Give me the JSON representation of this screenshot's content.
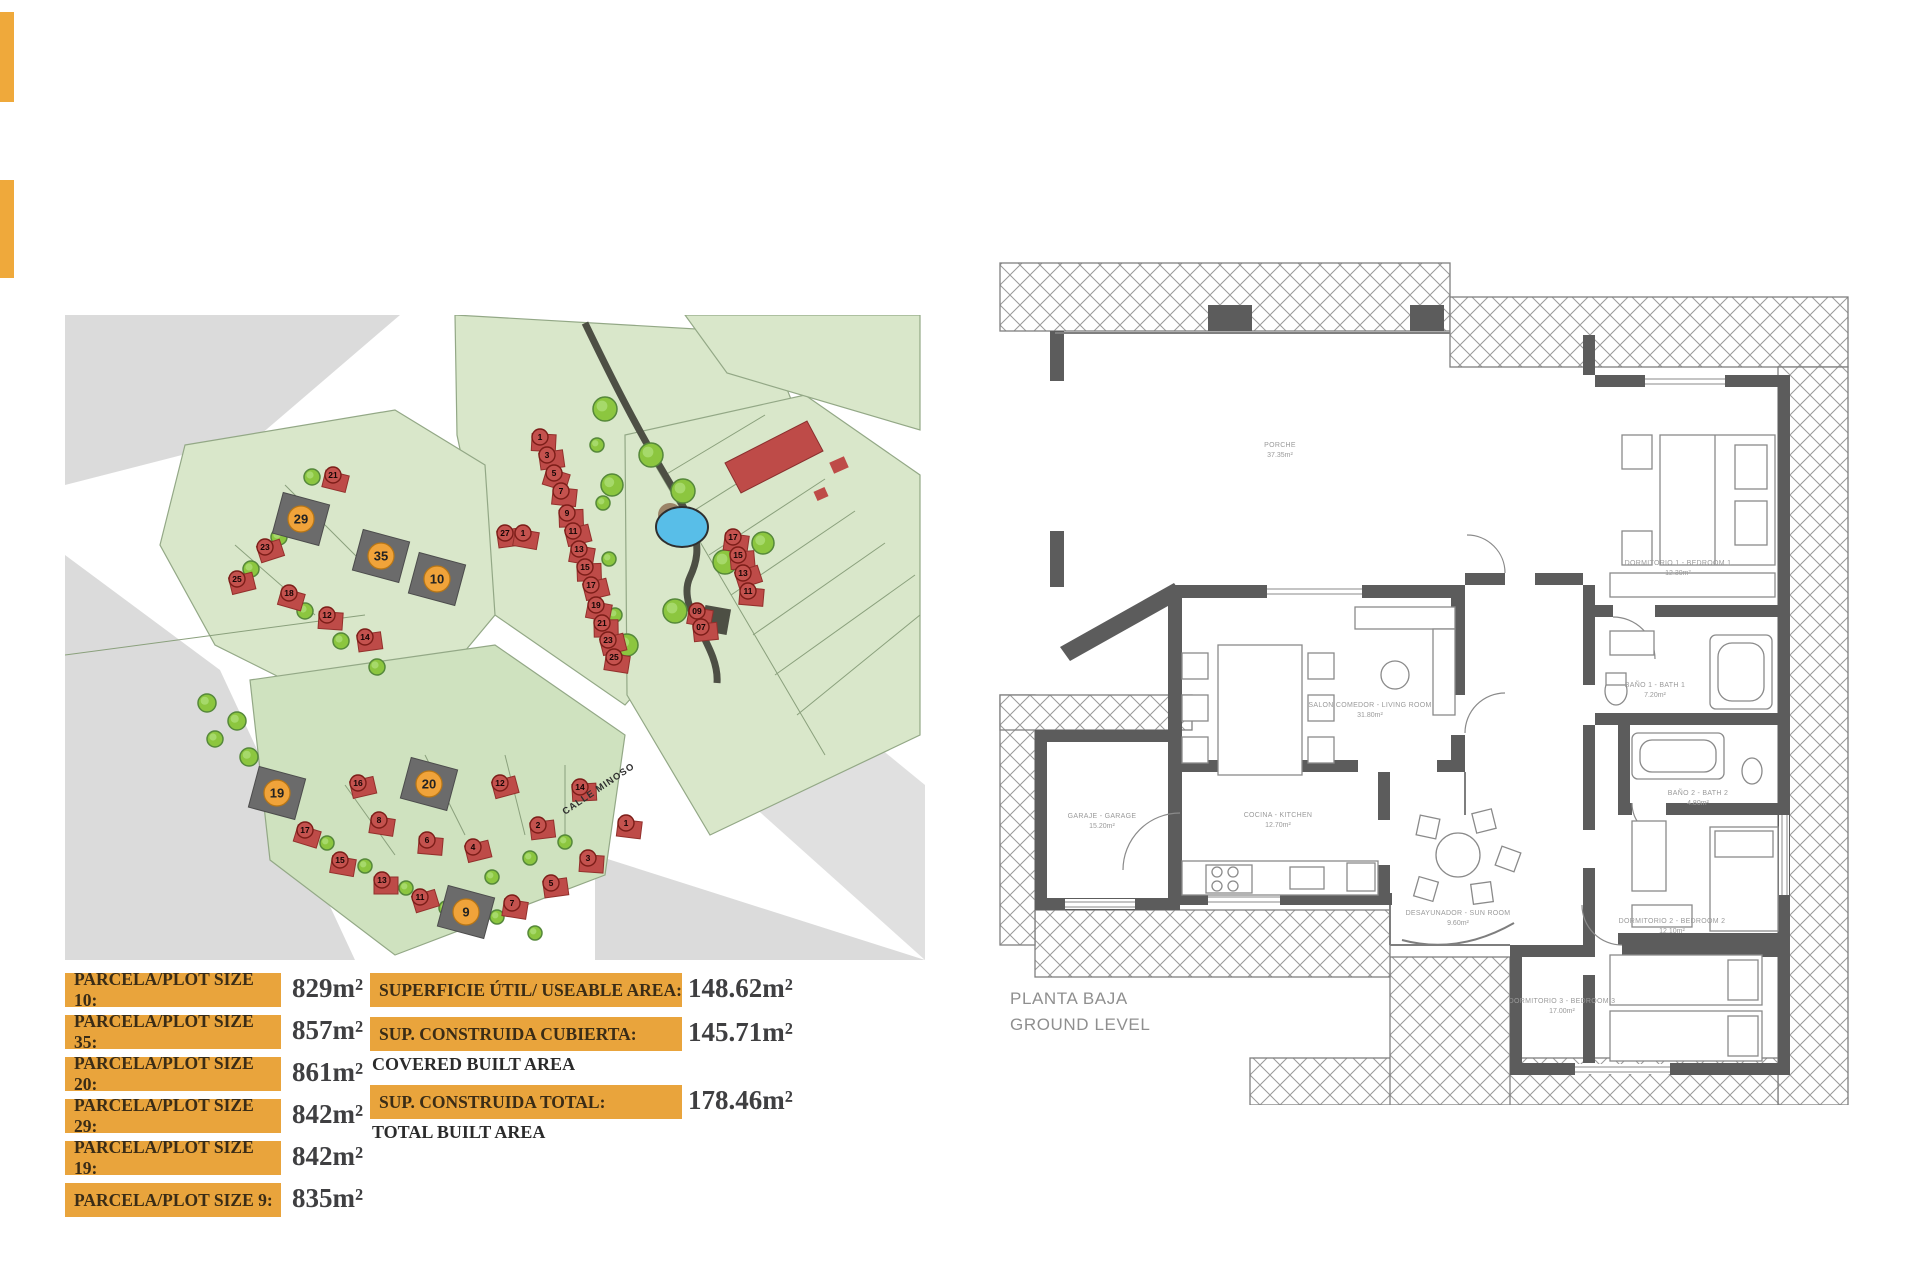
{
  "accent": {
    "orange": "#E9A43C",
    "bar_orange": "#EFA93B",
    "label_text": "#3A2C16",
    "value_text": "#3F3F41"
  },
  "site_map": {
    "street_label": "CALLE MINOSO",
    "green": "#D9E7CA",
    "green2": "#CFE2BF",
    "green_line": "#93A886",
    "gray": "#DBDBDB",
    "house_color": "#BE4B48",
    "plot_dark": "#6B6B6B",
    "pool_color": "#58BEE8",
    "orange": "#F0A33A",
    "highlighted_plots": [
      {
        "n": "29",
        "x": 236,
        "y": 204
      },
      {
        "n": "35",
        "x": 316,
        "y": 241
      },
      {
        "n": "10",
        "x": 372,
        "y": 264
      },
      {
        "n": "20",
        "x": 364,
        "y": 469
      },
      {
        "n": "19",
        "x": 212,
        "y": 478
      },
      {
        "n": "9",
        "x": 401,
        "y": 597
      }
    ],
    "red_plots": [
      {
        "n": "1",
        "x": 475,
        "y": 122
      },
      {
        "n": "3",
        "x": 482,
        "y": 140
      },
      {
        "n": "5",
        "x": 489,
        "y": 158
      },
      {
        "n": "7",
        "x": 496,
        "y": 176
      },
      {
        "n": "9",
        "x": 502,
        "y": 198
      },
      {
        "n": "11",
        "x": 508,
        "y": 216
      },
      {
        "n": "13",
        "x": 514,
        "y": 234
      },
      {
        "n": "15",
        "x": 520,
        "y": 252
      },
      {
        "n": "17",
        "x": 526,
        "y": 270
      },
      {
        "n": "19",
        "x": 531,
        "y": 290
      },
      {
        "n": "21",
        "x": 537,
        "y": 308
      },
      {
        "n": "23",
        "x": 543,
        "y": 325
      },
      {
        "n": "25",
        "x": 549,
        "y": 342
      },
      {
        "n": "17",
        "x": 668,
        "y": 222
      },
      {
        "n": "15",
        "x": 673,
        "y": 240
      },
      {
        "n": "13",
        "x": 678,
        "y": 258
      },
      {
        "n": "11",
        "x": 683,
        "y": 276
      },
      {
        "n": "09",
        "x": 632,
        "y": 296
      },
      {
        "n": "07",
        "x": 636,
        "y": 312
      },
      {
        "n": "27",
        "x": 440,
        "y": 218
      },
      {
        "n": "1",
        "x": 458,
        "y": 218
      },
      {
        "n": "21",
        "x": 268,
        "y": 160
      },
      {
        "n": "23",
        "x": 200,
        "y": 232
      },
      {
        "n": "25",
        "x": 172,
        "y": 264
      },
      {
        "n": "12",
        "x": 262,
        "y": 300
      },
      {
        "n": "14",
        "x": 300,
        "y": 322
      },
      {
        "n": "18",
        "x": 224,
        "y": 278
      },
      {
        "n": "16",
        "x": 293,
        "y": 468
      },
      {
        "n": "12",
        "x": 435,
        "y": 468
      },
      {
        "n": "14",
        "x": 515,
        "y": 472
      },
      {
        "n": "8",
        "x": 314,
        "y": 505
      },
      {
        "n": "6",
        "x": 362,
        "y": 525
      },
      {
        "n": "4",
        "x": 408,
        "y": 532
      },
      {
        "n": "2",
        "x": 473,
        "y": 510
      },
      {
        "n": "1",
        "x": 561,
        "y": 508
      },
      {
        "n": "3",
        "x": 523,
        "y": 543
      },
      {
        "n": "5",
        "x": 486,
        "y": 568
      },
      {
        "n": "7",
        "x": 447,
        "y": 588
      },
      {
        "n": "17",
        "x": 240,
        "y": 515
      },
      {
        "n": "15",
        "x": 275,
        "y": 545
      },
      {
        "n": "13",
        "x": 317,
        "y": 565
      },
      {
        "n": "11",
        "x": 355,
        "y": 582
      }
    ],
    "trees": [
      {
        "x": 540,
        "y": 94,
        "r": 12
      },
      {
        "x": 586,
        "y": 140,
        "r": 12
      },
      {
        "x": 547,
        "y": 170,
        "r": 11
      },
      {
        "x": 618,
        "y": 176,
        "r": 12
      },
      {
        "x": 660,
        "y": 247,
        "r": 12
      },
      {
        "x": 698,
        "y": 228,
        "r": 11
      },
      {
        "x": 610,
        "y": 296,
        "r": 12
      },
      {
        "x": 562,
        "y": 330,
        "r": 11
      },
      {
        "x": 247,
        "y": 162,
        "r": 8
      },
      {
        "x": 214,
        "y": 222,
        "r": 8
      },
      {
        "x": 186,
        "y": 254,
        "r": 8
      },
      {
        "x": 240,
        "y": 296,
        "r": 8
      },
      {
        "x": 276,
        "y": 326,
        "r": 8
      },
      {
        "x": 312,
        "y": 352,
        "r": 8
      },
      {
        "x": 142,
        "y": 388,
        "r": 9
      },
      {
        "x": 172,
        "y": 406,
        "r": 9
      },
      {
        "x": 150,
        "y": 424,
        "r": 8
      },
      {
        "x": 184,
        "y": 442,
        "r": 9
      },
      {
        "x": 262,
        "y": 528,
        "r": 7
      },
      {
        "x": 300,
        "y": 551,
        "r": 7
      },
      {
        "x": 341,
        "y": 573,
        "r": 7
      },
      {
        "x": 381,
        "y": 593,
        "r": 7
      },
      {
        "x": 427,
        "y": 562,
        "r": 7
      },
      {
        "x": 465,
        "y": 543,
        "r": 7
      },
      {
        "x": 500,
        "y": 527,
        "r": 7
      },
      {
        "x": 432,
        "y": 602,
        "r": 7
      },
      {
        "x": 470,
        "y": 618,
        "r": 7
      },
      {
        "x": 532,
        "y": 130,
        "r": 7
      },
      {
        "x": 538,
        "y": 188,
        "r": 7
      },
      {
        "x": 544,
        "y": 244,
        "r": 7
      },
      {
        "x": 550,
        "y": 300,
        "r": 7
      }
    ]
  },
  "plot_sizes": [
    {
      "label": "PARCELA/PLOT SIZE 10:",
      "value": "829m²"
    },
    {
      "label": "PARCELA/PLOT SIZE 35:",
      "value": "857m²"
    },
    {
      "label": "PARCELA/PLOT SIZE 20:",
      "value": "861m²"
    },
    {
      "label": "PARCELA/PLOT SIZE 29:",
      "value": "842m²"
    },
    {
      "label": "PARCELA/PLOT SIZE 19:",
      "value": "842m²"
    },
    {
      "label": "PARCELA/PLOT SIZE 9:",
      "value": "835m²"
    }
  ],
  "areas": [
    {
      "label": "SUPERFICIE ÚTIL/ USEABLE AREA:",
      "sub": "",
      "value": "148.62m²"
    },
    {
      "label": "SUP. CONSTRUIDA CUBIERTA:",
      "sub": "COVERED BUILT AREA",
      "value": "145.71m²"
    },
    {
      "label": "SUP. CONSTRUIDA TOTAL:",
      "sub": "TOTAL BUILT AREA",
      "value": "178.46m²"
    }
  ],
  "floor_plan": {
    "title_line1": "PLANTA BAJA",
    "title_line2": "GROUND LEVEL",
    "rooms": [
      {
        "name": "PORCHE",
        "area": "37.35m²",
        "x": 470,
        "y": 192
      },
      {
        "name": "SALON COMEDOR - LIVING ROOM",
        "area": "31.80m²",
        "x": 560,
        "y": 452
      },
      {
        "name": "COCINA - KITCHEN",
        "area": "12.70m²",
        "x": 468,
        "y": 562
      },
      {
        "name": "GARAJE - GARAGE",
        "area": "15.20m²",
        "x": 292,
        "y": 563
      },
      {
        "name": "DORMITORIO 1 - BEDROOM 1",
        "area": "12.30m²",
        "x": 868,
        "y": 310
      },
      {
        "name": "BAÑO 1 - BATH 1",
        "area": "7.20m²",
        "x": 845,
        "y": 432
      },
      {
        "name": "BAÑO 2 - BATH 2",
        "area": "4.80m²",
        "x": 888,
        "y": 540
      },
      {
        "name": "DORMITORIO 2 - BEDROOM 2",
        "area": "12.10m²",
        "x": 862,
        "y": 668
      },
      {
        "name": "DESAYUNADOR - SUN ROOM",
        "area": "9.60m²",
        "x": 648,
        "y": 660
      },
      {
        "name": "DORMITORIO 3 - BEDROOM 3",
        "area": "17.00m²",
        "x": 752,
        "y": 748
      }
    ]
  }
}
